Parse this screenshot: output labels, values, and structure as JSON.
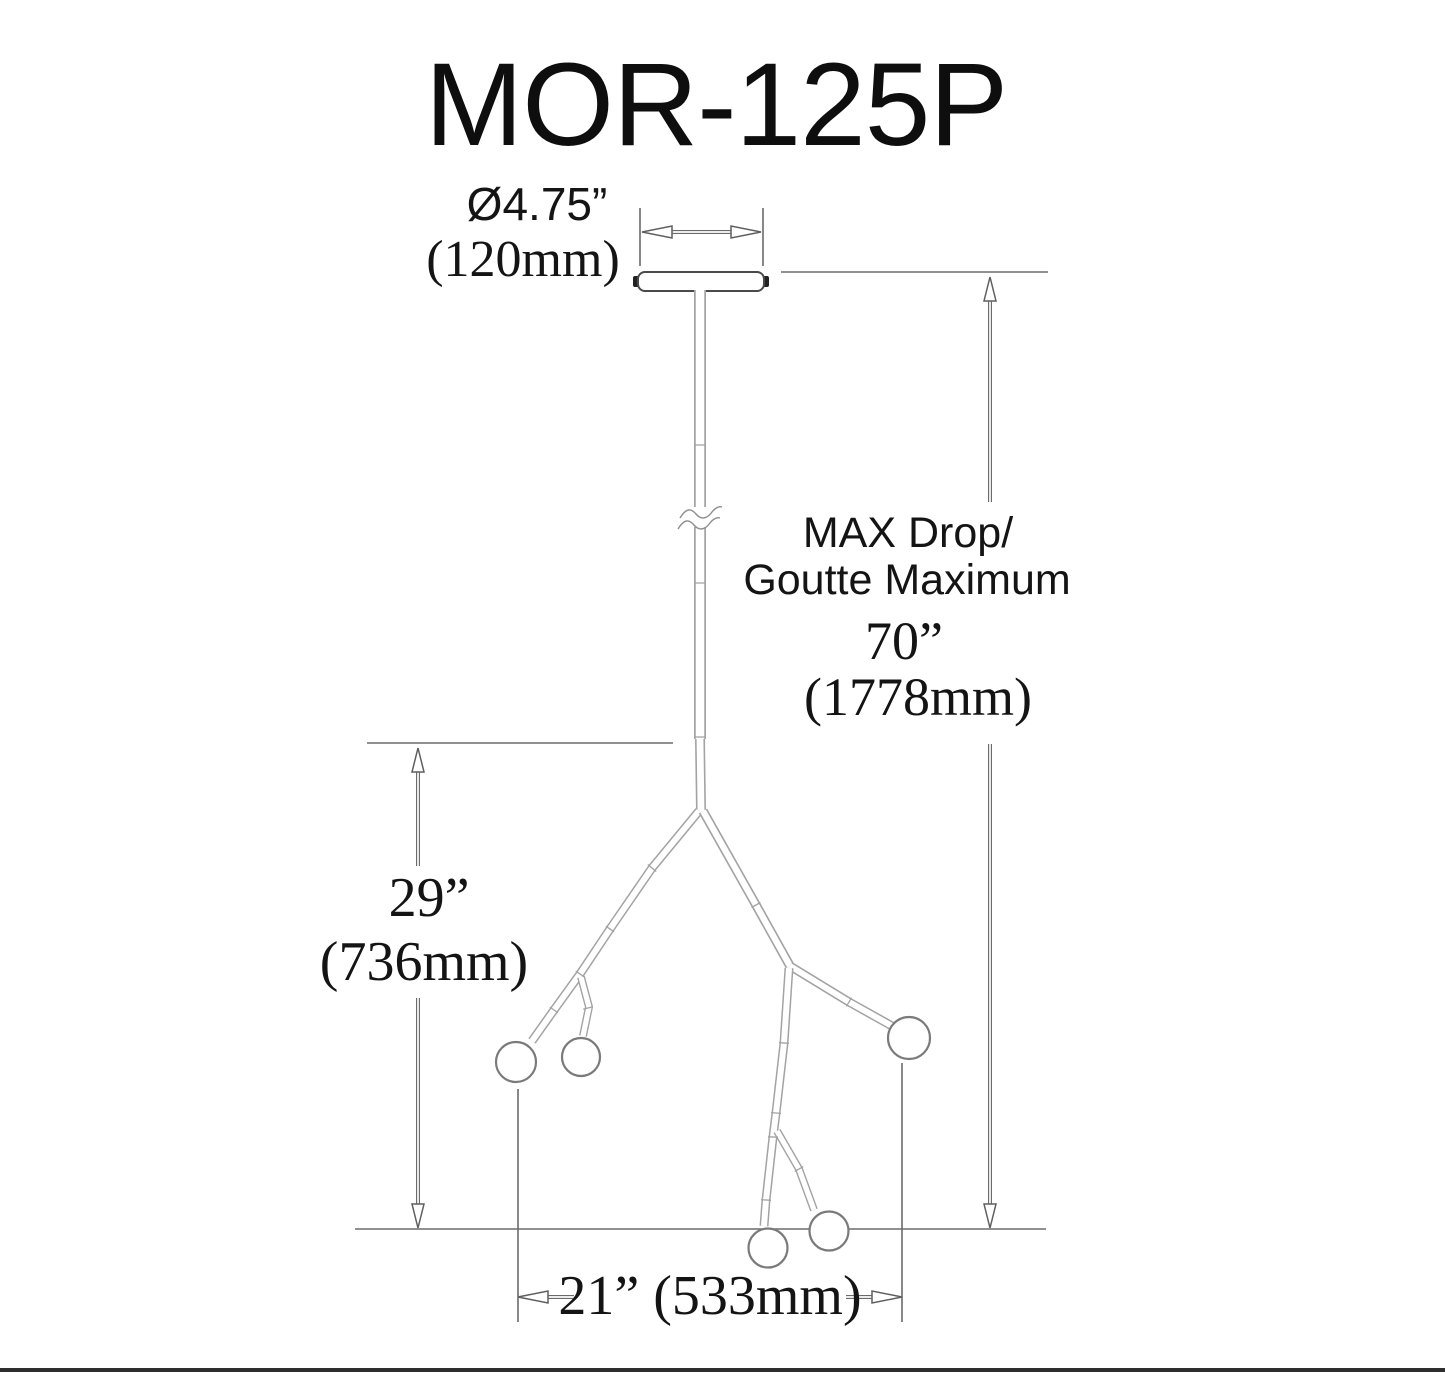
{
  "drawing": {
    "title": "MOR-125P",
    "canopy": {
      "diameter_in": "Ø4.75”",
      "diameter_mm": "(120mm)"
    },
    "max_drop": {
      "label_en": "MAX Drop/",
      "label_fr": "Goutte Maximum",
      "value_in": "70”",
      "value_mm": "(1778mm)"
    },
    "body_height": {
      "value_in": "29”",
      "value_mm": "(736mm)"
    },
    "body_width": {
      "value": "21” (533mm)"
    },
    "colors": {
      "text": "#141414",
      "dimension_lines": "#6b6b6b",
      "fixture_lines": "#a3a3a3",
      "canopy_outline": "#4a4a4a",
      "bottom_rule": "#2e2e2e"
    }
  }
}
